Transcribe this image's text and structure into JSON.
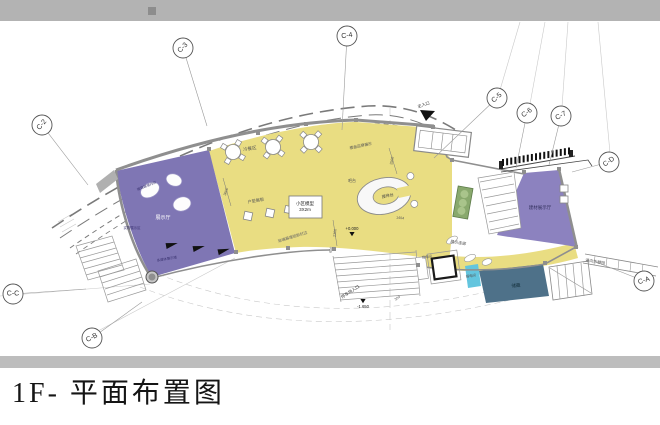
{
  "title": "1F- 平面布置图",
  "colors": {
    "top_bar": "#b3b3b3",
    "bottom_bar": "#bdbdbd",
    "yellow": "#e9dd82",
    "purple_left": "#7f76b4",
    "purple_right": "#8c82bf",
    "teal": "#4e7189",
    "cyan": "#63c5de",
    "green": "#89a96d",
    "wall": "#8f8f8f"
  },
  "grid_markers": [
    {
      "label": "C-2",
      "cx": 42,
      "cy": 125,
      "rot": -50,
      "lx": 88,
      "ly": 185
    },
    {
      "label": "C-3",
      "cx": 183,
      "cy": 48,
      "rot": -45,
      "lx": 207,
      "ly": 126
    },
    {
      "label": "C-4",
      "cx": 347,
      "cy": 36,
      "rot": -8,
      "lx": 342,
      "ly": 130
    },
    {
      "label": "C-5",
      "cx": 497,
      "cy": 98,
      "rot": -42,
      "lx": 434,
      "ly": 158
    },
    {
      "label": "C-6",
      "cx": 527,
      "cy": 113,
      "rot": -35,
      "lx": 516,
      "ly": 168
    },
    {
      "label": "C-7",
      "cx": 561,
      "cy": 116,
      "rot": -28,
      "lx": 549,
      "ly": 165
    },
    {
      "label": "C-D",
      "cx": 609,
      "cy": 162,
      "rot": -35,
      "lx": 572,
      "ly": 172
    },
    {
      "label": "C-A",
      "cx": 644,
      "cy": 281,
      "rot": -18,
      "lx": 596,
      "ly": 262
    },
    {
      "label": "C-B",
      "cx": 92,
      "cy": 338,
      "rot": -28,
      "lx": 142,
      "ly": 302
    },
    {
      "label": "C-C",
      "cx": 13,
      "cy": 294,
      "rot": 0,
      "lx": 86,
      "ly": 289
    }
  ],
  "labels": [
    {
      "id": "cold-buffet-area",
      "text": "冷餐区",
      "x": 250,
      "y": 150,
      "s": 4.5,
      "r": -8,
      "c": "#555"
    },
    {
      "id": "unit-display-boards",
      "text": "户型展板",
      "x": 256,
      "y": 202,
      "s": 4.2,
      "r": -10,
      "c": "#555"
    },
    {
      "id": "model-title",
      "text": "小区模型",
      "x": 305,
      "y": 205,
      "s": 4.5,
      "r": 0,
      "c": "#222"
    },
    {
      "id": "model-size",
      "text": "3X2m",
      "x": 305,
      "y": 211,
      "s": 4.5,
      "r": 0,
      "c": "#222"
    },
    {
      "id": "bar-counter",
      "text": "吧台",
      "x": 352,
      "y": 182,
      "s": 4,
      "r": 0,
      "c": "#555"
    },
    {
      "id": "reception-desk-label",
      "text": "接待台",
      "x": 388,
      "y": 197,
      "s": 4,
      "r": -12,
      "c": "#444"
    },
    {
      "id": "exhibition-hall",
      "text": "展示厅",
      "x": 163,
      "y": 219,
      "s": 5,
      "r": 0,
      "c": "#ffffff"
    },
    {
      "id": "materials-hall",
      "text": "建材展示厅",
      "x": 540,
      "y": 209,
      "s": 4.5,
      "r": 0,
      "c": "#33305e"
    },
    {
      "id": "display-corridor",
      "text": "展示连廊",
      "x": 458,
      "y": 244,
      "s": 4,
      "r": 9,
      "c": "#555"
    },
    {
      "id": "storage",
      "text": "储藏",
      "x": 516,
      "y": 287,
      "s": 4.5,
      "r": -4,
      "c": "#14303c"
    },
    {
      "id": "main-entrance",
      "text": "主入口",
      "x": 424,
      "y": 106,
      "s": 4.2,
      "r": -18,
      "c": "#333"
    },
    {
      "id": "parking-entrance",
      "text": "停车场入口",
      "x": 351,
      "y": 293,
      "s": 4.2,
      "r": -33,
      "c": "#333"
    },
    {
      "id": "to-rest-garden",
      "text": "通向休憩园",
      "x": 595,
      "y": 263,
      "s": 4,
      "r": 9,
      "c": "#555"
    },
    {
      "id": "curtain-wall-note",
      "text": "玻璃幕墙铝板封边",
      "x": 293,
      "y": 238,
      "s": 3.8,
      "r": -17,
      "c": "#666"
    },
    {
      "id": "brand-display",
      "text": "楼盘品牌展示",
      "x": 361,
      "y": 147,
      "s": 3.8,
      "r": -12,
      "c": "#555"
    },
    {
      "id": "strong-electric-room",
      "text": "强电间",
      "x": 427,
      "y": 258,
      "s": 3.4,
      "r": -8,
      "c": "#555"
    },
    {
      "id": "weak-electric-room",
      "text": "弱电间",
      "x": 471,
      "y": 277,
      "s": 3.4,
      "r": -8,
      "c": "#555"
    },
    {
      "id": "curtain-wall-inner",
      "text": "玻璃幕墙内侧",
      "x": 147,
      "y": 187,
      "s": 3.4,
      "r": -22,
      "c": "#3a3370"
    },
    {
      "id": "object-display-area",
      "text": "实物展示区",
      "x": 132,
      "y": 229,
      "s": 3.4,
      "r": 0,
      "c": "#3a3370"
    },
    {
      "id": "media-wall",
      "text": "多媒体展示墙",
      "x": 167,
      "y": 260,
      "s": 3.4,
      "r": -10,
      "c": "#3a3370"
    }
  ],
  "dimensions": [
    {
      "text": "2500",
      "x": 393,
      "y": 161,
      "r": -78
    },
    {
      "text": "3600",
      "x": 227,
      "y": 192,
      "r": -72
    },
    {
      "text": "2300",
      "x": 336,
      "y": 233,
      "r": -82
    },
    {
      "text": "1404",
      "x": 400,
      "y": 219,
      "r": 6
    },
    {
      "text": "600",
      "x": 332,
      "y": 250,
      "r": -80
    },
    {
      "text": "300",
      "x": 398,
      "y": 299,
      "r": -35
    }
  ],
  "levels": [
    {
      "text": "+0.000",
      "x": 352,
      "y": 230,
      "tx": 352,
      "ty": 232
    },
    {
      "text": "-1.650",
      "x": 363,
      "y": 308,
      "tx": 363,
      "ty": 299
    }
  ]
}
